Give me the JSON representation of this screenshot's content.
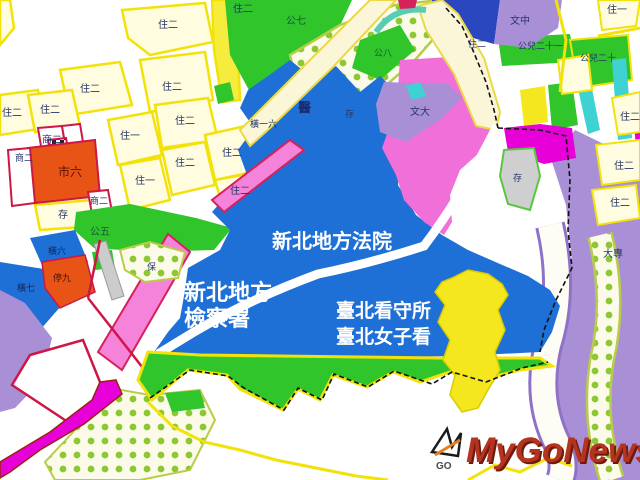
{
  "map_title": "新北地方法院周邊都市計畫示意圖",
  "zones": {
    "residential2": "住二",
    "residential1": "住一",
    "market6": "市六",
    "commercial2": "商二",
    "storage": "存",
    "park5": "公五",
    "park7": "公七",
    "park8": "公八",
    "park_child20": "公兒二十",
    "park_child21": "公兒二十一",
    "hospital": "醫",
    "heng16": "橫一六",
    "heng6": "橫六",
    "heng7": "橫七",
    "parking9": "停九",
    "bao": "保",
    "school_mid": "文中",
    "school_univ": "文大",
    "college": "大專"
  },
  "institutions": {
    "court": "新北地方法院",
    "prosecutor_line1": "新北地方",
    "prosecutor_line2": "檢察署",
    "detention": "臺北看守所",
    "women_detention": "臺北女子看"
  },
  "watermark": {
    "brand": "MyGoNews",
    "icon_label": "GO"
  },
  "colors": {
    "residential_fill": "#FFFCE0",
    "road_yellow": "#F2E20A",
    "park_green": "#2FC52B",
    "institution_blue": "#1E6FD6",
    "dark_blue": "#2B47C0",
    "pink": "#F06FD8",
    "magenta": "#E800D8",
    "violet": "#A98FD6",
    "cyan": "#3ED2D2",
    "orange_red": "#E85316",
    "crimson": "#CC1747",
    "watermark_red": "#B5341F"
  }
}
